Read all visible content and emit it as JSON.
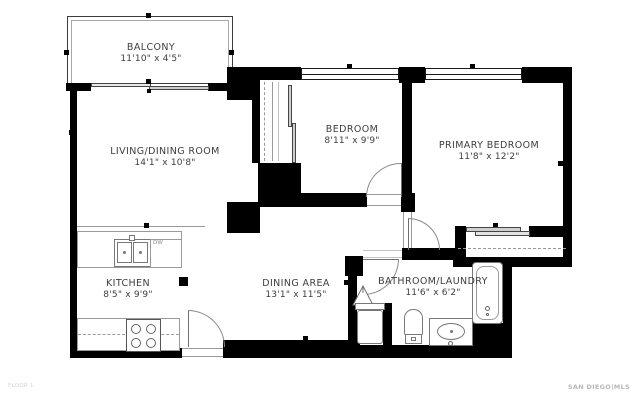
{
  "title": "Floor plan",
  "rooms": {
    "balcony": {
      "name": "BALCONY",
      "dims": "11'10\" x 4'5\""
    },
    "living": {
      "name": "LIVING/DINING ROOM",
      "dims": "14'1\" x 10'8\""
    },
    "bedroom": {
      "name": "BEDROOM",
      "dims": "8'11\" x 9'9\""
    },
    "primary": {
      "name": "PRIMARY BEDROOM",
      "dims": "11'8\" x 12'2\""
    },
    "kitchen": {
      "name": "KITCHEN",
      "dims": "8'5\" x 9'9\""
    },
    "dining": {
      "name": "DINING AREA",
      "dims": "13'1\" x 11'5\""
    },
    "bathroom": {
      "name": "BATHROOM/LAUNDRY",
      "dims": "11'6\" x 6'2\""
    }
  },
  "fixtures": {
    "dishwasher_label": "DW"
  },
  "footer": {
    "left": "FLOOR 1",
    "right": "SAN DIEGO|MLS"
  },
  "colors": {
    "wall": "#000000",
    "fixture_line": "#787878",
    "room_text": "#3d3d3d",
    "footer_text": "#b8b8b8",
    "background": "#ffffff"
  }
}
